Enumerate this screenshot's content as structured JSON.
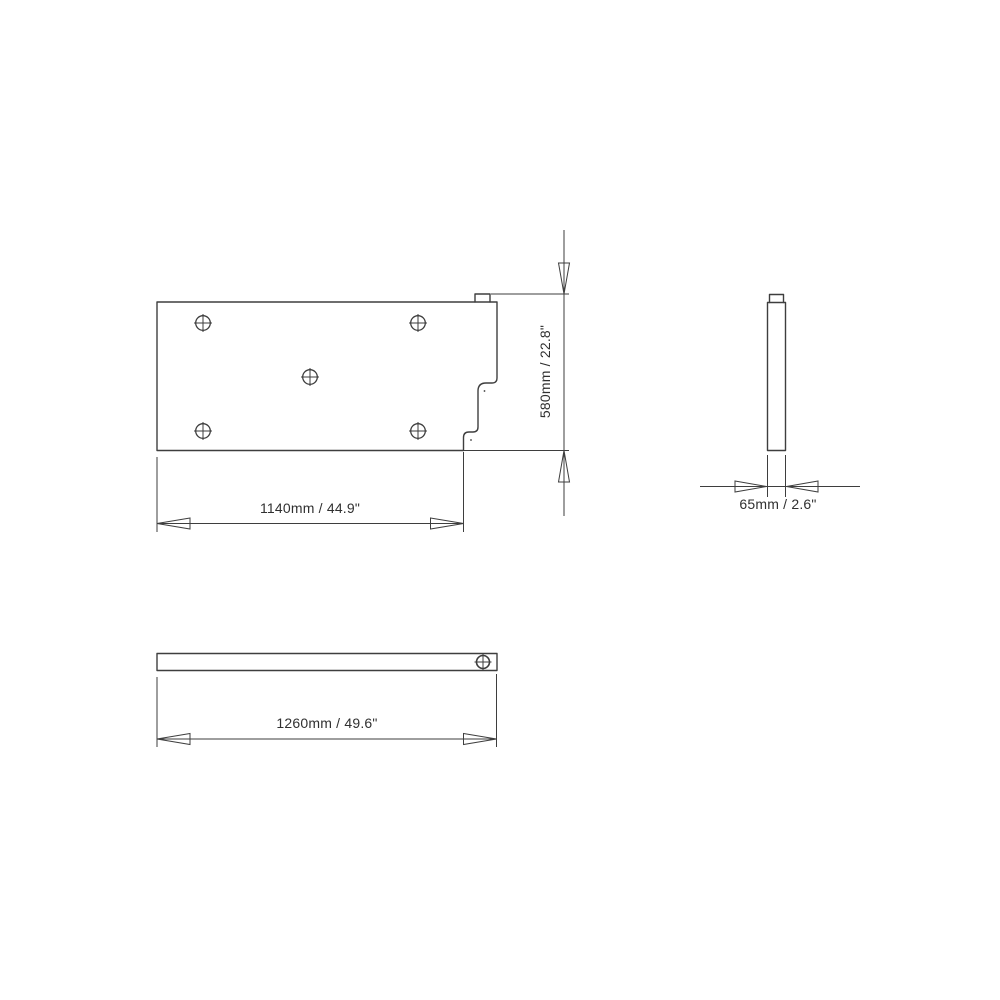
{
  "page": {
    "background_color": "#ffffff",
    "line_color": "#3e3e3e",
    "text_color": "#303030"
  },
  "drawing": {
    "type": "technical-dimension-drawing",
    "views": {
      "front_view": {
        "width_label": "1140mm / 44.9\"",
        "height_label": "580mm / 22.8\"",
        "hole_count": 5
      },
      "side_view": {
        "thickness_label": "65mm / 2.6\""
      },
      "top_view": {
        "width_label": "1260mm / 49.6\"",
        "hole_count": 1
      }
    }
  }
}
